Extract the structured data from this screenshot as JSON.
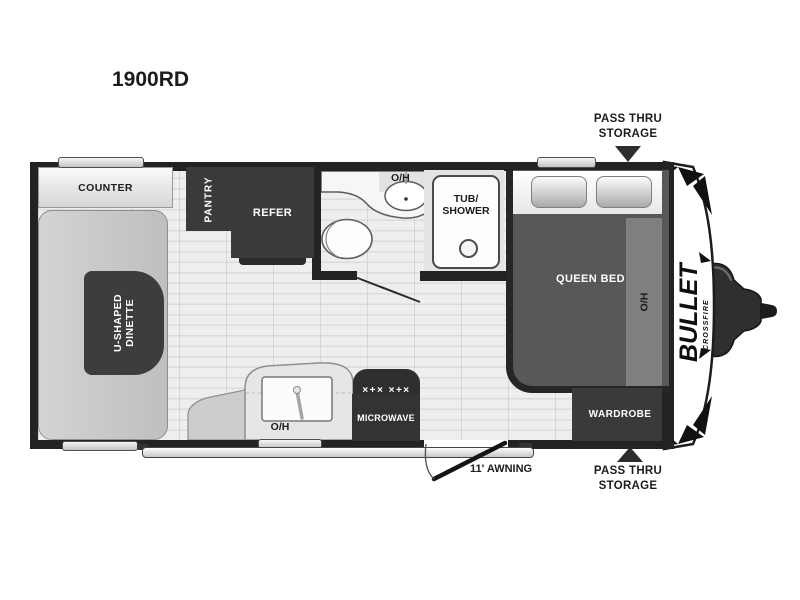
{
  "model": "1900RD",
  "brand": {
    "name": "BULLET",
    "model_line": "CROSSFIRE"
  },
  "annotations": {
    "pass_thru_top": {
      "line1": "PASS THRU",
      "line2": "STORAGE"
    },
    "pass_thru_bottom": {
      "line1": "PASS THRU",
      "line2": "STORAGE"
    },
    "awning": "11' AWNING"
  },
  "rooms": {
    "counter": "COUNTER",
    "pantry": "PANTRY",
    "refer": "REFER",
    "dinette": {
      "line1": "U-SHAPED",
      "line2": "DINETTE"
    },
    "bath_overhead": "O/H",
    "tub": {
      "line1": "TUB/",
      "line2": "SHOWER"
    },
    "queen_bed": "QUEEN BED",
    "bed_overhead": "O/H",
    "wardrobe": "WARDROBE",
    "microwave": "MICROWAVE",
    "stove_burners": "×+× ×+×",
    "kitchen_overhead": "O/H"
  },
  "colors": {
    "wall": "#232323",
    "dark_furniture": "#3a3a3a",
    "bed": "#585858",
    "bench": "#c6c6c6",
    "counter_light": "#e6e6e6",
    "floor": "#ececec",
    "text_dark": "#1c1c1c",
    "text_light": "#ffffff",
    "overhead_overlay": "rgba(160,160,160,0.55)"
  }
}
